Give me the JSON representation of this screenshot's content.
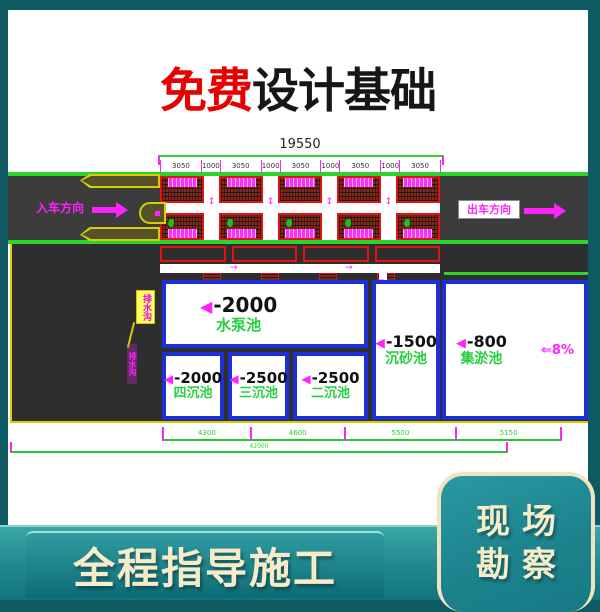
{
  "banner": {
    "highlight": "免费",
    "rest": "设计基础"
  },
  "drawing": {
    "total_dim_top": "19550",
    "top_dims": [
      "3050",
      "1000",
      "3050",
      "1000",
      "3050",
      "1000",
      "3050",
      "1000",
      "3050"
    ],
    "entry_label": "入车方向",
    "exit_label": "出车方向",
    "annotation_label": "排水沟",
    "annotation_small_label": "排水沟",
    "pool_marker": "◀",
    "gap_arrow": "↕",
    "channel_arrow": "→",
    "pipe_arrow": "▼",
    "slope_label": "⇐8%",
    "pools": [
      {
        "elev": "-2000",
        "name": "水泵池"
      },
      {
        "elev": "-2000",
        "name": "四沉池"
      },
      {
        "elev": "-2500",
        "name": "三沉池"
      },
      {
        "elev": "-2500",
        "name": "二沉池"
      },
      {
        "elev": "-1500",
        "name": "沉砂池"
      },
      {
        "elev": "-800",
        "name": "集淤池"
      }
    ],
    "bottom_dims": [
      "4300",
      "4600",
      "5500",
      "5150"
    ],
    "total_dim_bottom": "42000"
  },
  "footer": {
    "bar_label": "全程指导施工",
    "card_line1": "现场",
    "card_line2": "勘察"
  },
  "colors": {
    "background_teal": "#0d5a62",
    "band_teal": "#1b828c",
    "magenta": "#ff22ff",
    "cad_green": "#2bd42b",
    "pool_border_blue": "#1d2fd6",
    "hatch_red": "#e01212",
    "island_yellow": "#d6ce00",
    "label_green": "#23cf3f",
    "title_red": "#e60000",
    "cream": "#f6ecc9",
    "road_gray": "#3c3c3c"
  }
}
